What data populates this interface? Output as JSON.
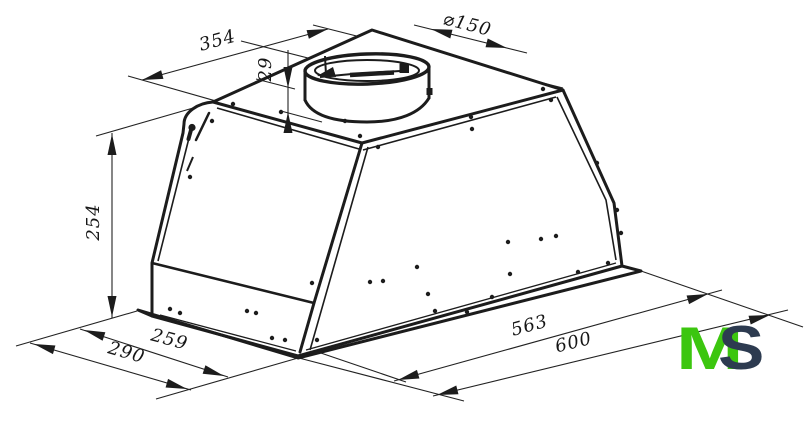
{
  "drawing": {
    "background": "#ffffff",
    "line_color": "#1c1c1c",
    "dimensions": {
      "top_width": "354",
      "duct_diameter": "⌀150",
      "collar_height": "29",
      "height": "254",
      "bottom_depth_inner": "259",
      "bottom_depth_outer": "290",
      "bottom_width_inner": "563",
      "bottom_width_outer": "600"
    }
  },
  "logo": {
    "letter_m": "M",
    "letter_s": "S",
    "m_color": "#3cc60f",
    "s_color": "#2d3b50"
  }
}
